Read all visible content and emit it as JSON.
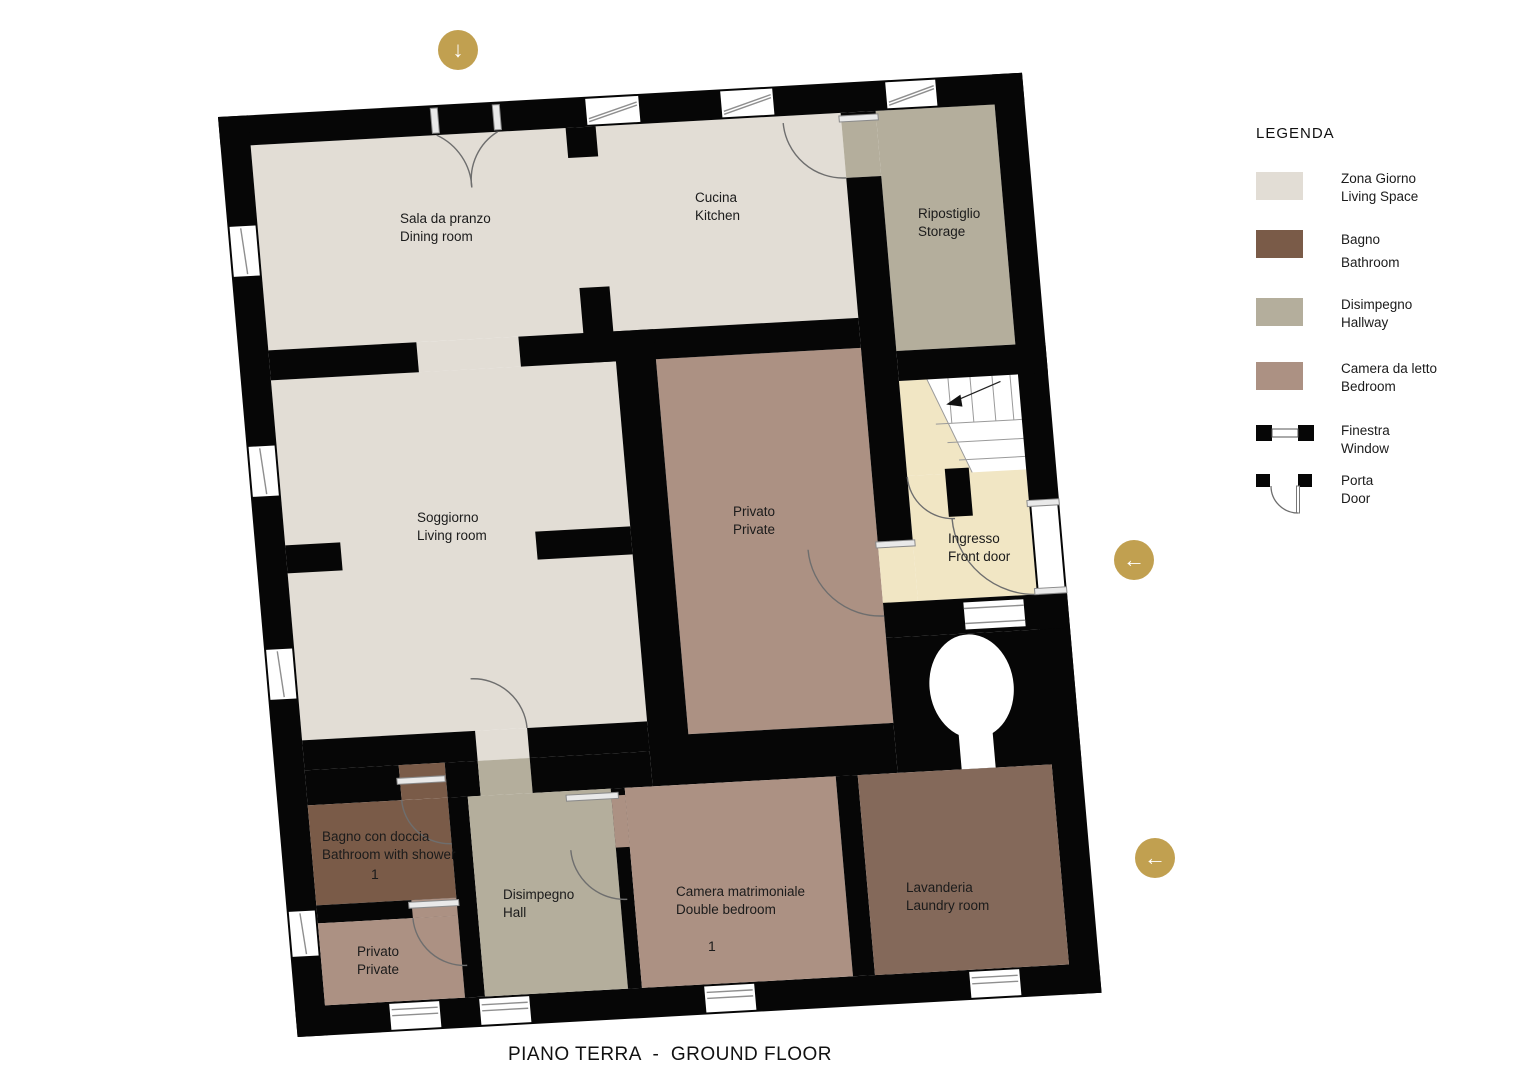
{
  "title": "PIANO TERRA  -  GROUND FLOOR",
  "legend": {
    "title": "LEGENDA",
    "areas": [
      {
        "it": "Zona Giorno",
        "en": "Living Space",
        "color": "#E2DDD5"
      },
      {
        "it": "Bagno",
        "en": "Bathroom",
        "color": "#7A5B48"
      },
      {
        "it": "Disimpegno",
        "en": "Hallway",
        "color": "#B4AE9C"
      },
      {
        "it": "Camera da letto",
        "en": "Bedroom",
        "color": "#AC9183"
      }
    ],
    "symbols": [
      {
        "it": "Finestra",
        "en": "Window"
      },
      {
        "it": "Porta",
        "en": "Door"
      }
    ]
  },
  "rooms": {
    "dining": {
      "it": "Sala da pranzo",
      "en": "Dining room"
    },
    "kitchen": {
      "it": "Cucina",
      "en": "Kitchen"
    },
    "storage": {
      "it": "Ripostiglio",
      "en": "Storage"
    },
    "living": {
      "it": "Soggiorno",
      "en": "Living room"
    },
    "private_center": {
      "it": "Privato",
      "en": "Private"
    },
    "entrance": {
      "it": "Ingresso",
      "en": "Front door"
    },
    "bathroom": {
      "it": "Bagno con doccia",
      "en": "Bathroom with shower",
      "count": "1"
    },
    "private_small": {
      "it": "Privato",
      "en": "Private"
    },
    "hall": {
      "it": "Disimpegno",
      "en": "Hall"
    },
    "double_bedroom": {
      "it": "Camera matrimoniale",
      "en": "Double bedroom",
      "count": "1"
    },
    "laundry": {
      "it": "Lavanderia",
      "en": "Laundry room"
    }
  },
  "buttons": {
    "down_arrow": "↓",
    "left_arrow": "←"
  },
  "colors": {
    "accent": "#C1A050",
    "wall": "#060606",
    "living_space": "#E2DDD5",
    "bathroom": "#7A5B48",
    "hallway": "#B4AE9C",
    "bedroom": "#AC9183",
    "laundry": "#84695A",
    "entrance": "#F1E6C4"
  }
}
